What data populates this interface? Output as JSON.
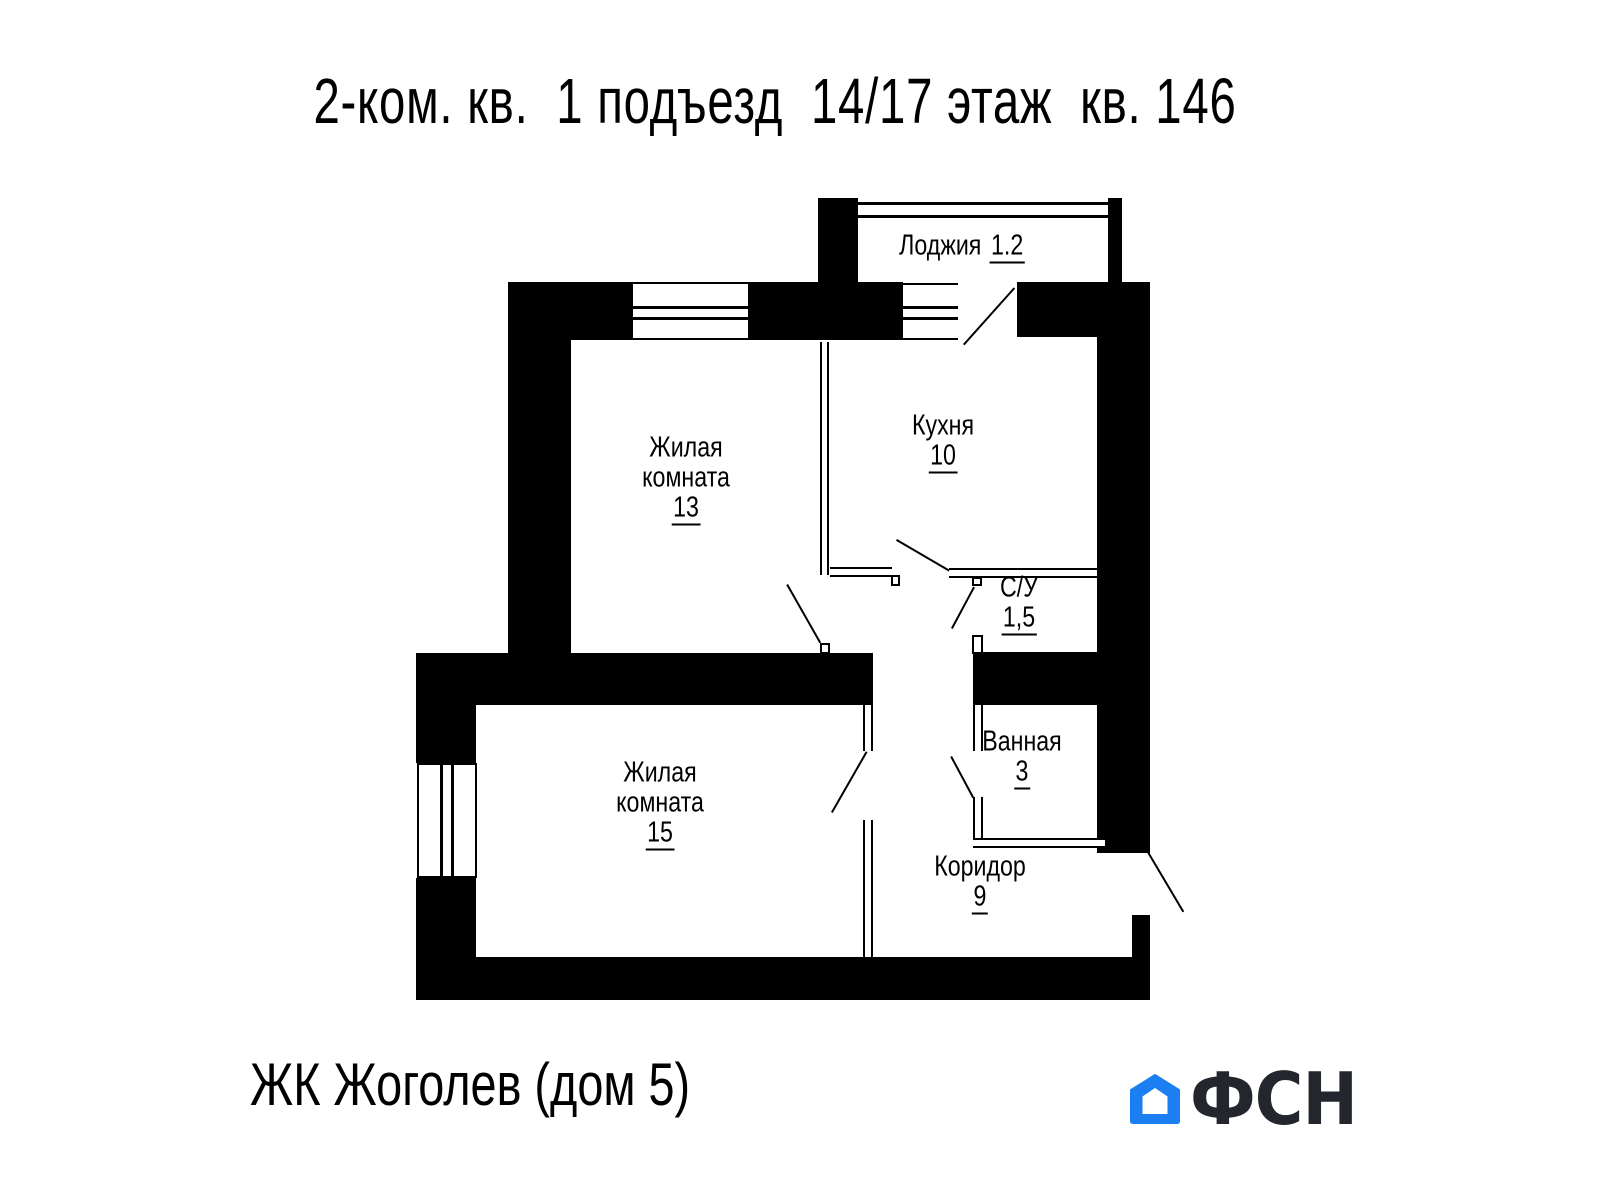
{
  "title": "2-ком. кв.  1 подъезд  14/17 этаж  кв. 146",
  "rooms": {
    "loggia": {
      "label": "Лоджия",
      "area": "1.2"
    },
    "room13": {
      "line1": "Жилая",
      "line2": "комната",
      "area": "13"
    },
    "kitchen": {
      "label": "Кухня",
      "area": "10"
    },
    "wc": {
      "label": "С/У",
      "area": "1,5"
    },
    "bath": {
      "label": "Ванная",
      "area": "3"
    },
    "room15": {
      "line1": "Жилая",
      "line2": "комната",
      "area": "15"
    },
    "corridor": {
      "label": "Коридор",
      "area": "9"
    }
  },
  "footer": {
    "complex": "ЖК Жоголев (дом 5)",
    "brand": "ФСН"
  },
  "colors": {
    "walls": "#000000",
    "background": "#ffffff",
    "logo_blue": "#1b7ff2",
    "logo_dark": "#23262c"
  }
}
